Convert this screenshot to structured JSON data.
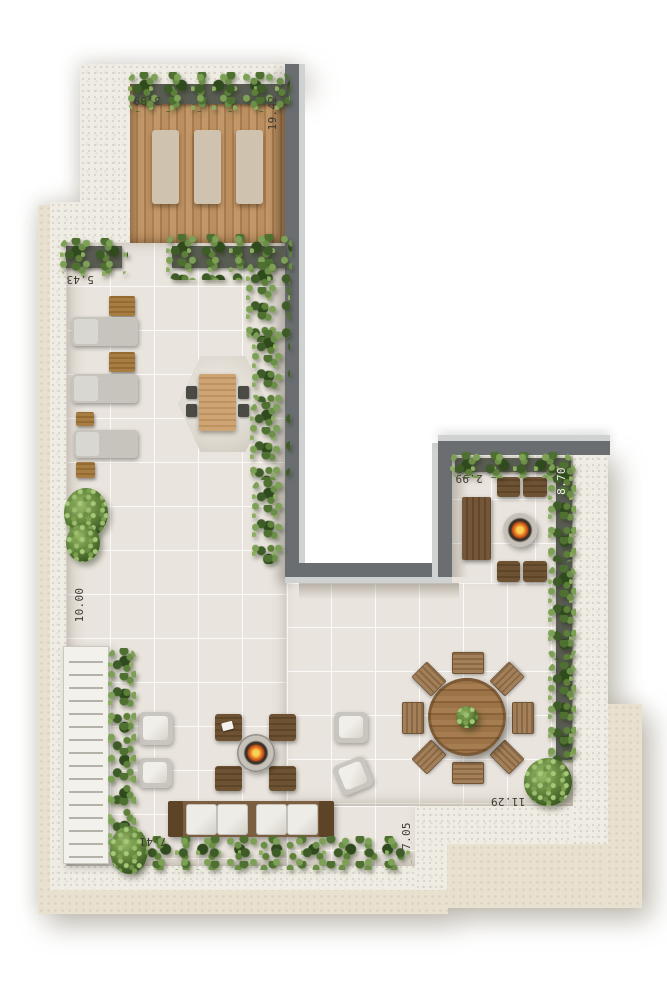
{
  "plan": {
    "type": "rooftop-terrace-floor-plan",
    "dims": {
      "deck_top": "3.89",
      "deck_side": "19.42",
      "upper_terrace": "5.43",
      "left_side": "10.00",
      "fire_terrace": "2.99",
      "right_side": "8.70",
      "lower_right": "11.29",
      "lower_left": "7.41",
      "lower_side": "7.05"
    },
    "palette": {
      "wall": "#6a6e70",
      "wall_cap": "#d0d2d1",
      "deck_wood": "#b5895a",
      "floor_tile": "#e9e4dd",
      "parapet": "#efece4",
      "ledge": "#e9e1d0",
      "plant_dark": "#3e5c27",
      "plant_light": "#7ca155",
      "flame": "#ee8c2d",
      "label_dark": "#3e3a32",
      "label_light": "#f2f0e9"
    },
    "furniture_counts": {
      "deck_sun_loungers": 3,
      "terrace_loungers": 3,
      "side_tables": 4,
      "fire_pits": 2,
      "lounge_armchairs": 4,
      "lounge_ottomans": 4,
      "sofa_cushions": 4,
      "dining_chairs": 8,
      "fire_terrace_chairs": 4
    }
  }
}
